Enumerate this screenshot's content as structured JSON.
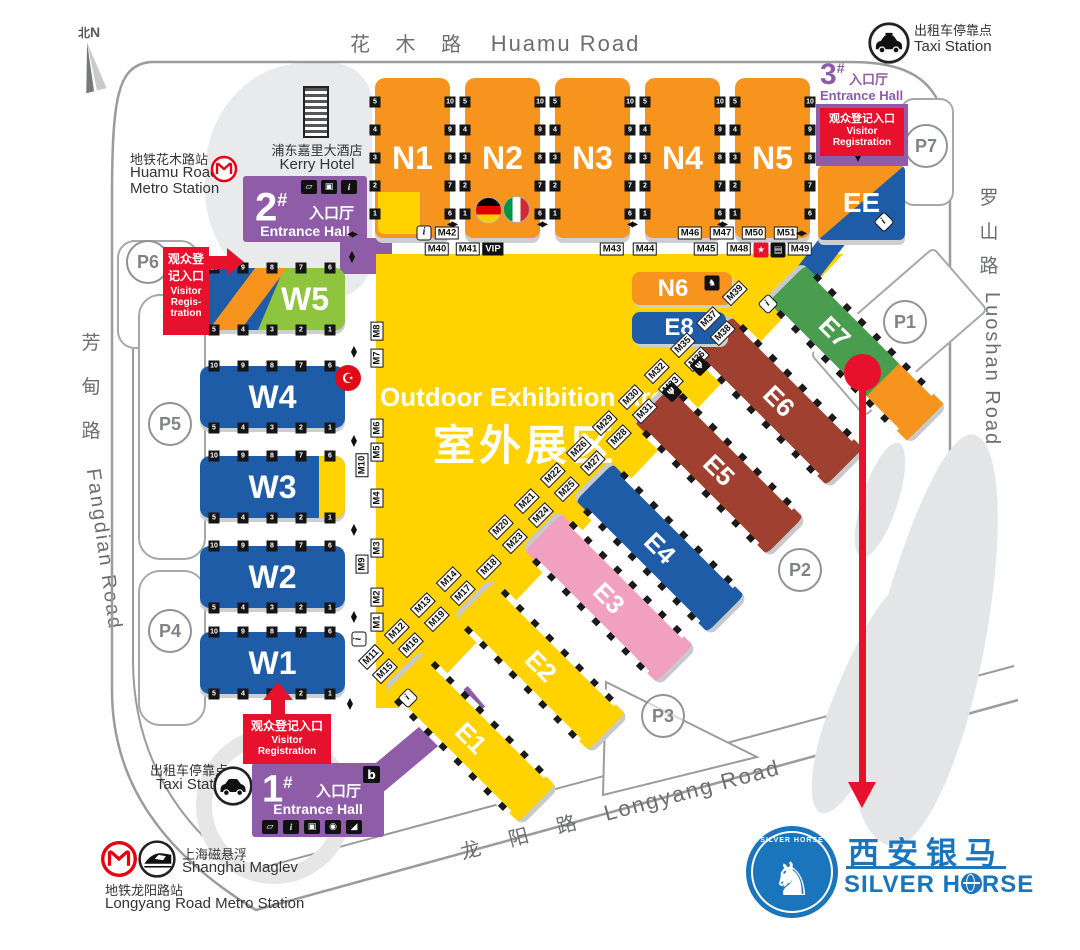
{
  "compass": {
    "zh": "北",
    "en": "N"
  },
  "roads": {
    "huamu": {
      "zh": "花  木  路",
      "en": "Huamu Road"
    },
    "luoshan": {
      "zhChars": [
        "罗",
        "山",
        "路"
      ],
      "en": "Luoshan Road"
    },
    "fangdian": {
      "zhChars": [
        "芳",
        "甸",
        "路"
      ],
      "en": "Fangdian Road"
    },
    "longyang": {
      "zh": "龙  阳  路",
      "en": "Longyang Road"
    }
  },
  "places": {
    "kerry": {
      "zh": "浦东嘉里大酒店",
      "en": "Kerry Hotel"
    },
    "huamuMetro": {
      "zh": "地铁花木路站",
      "en1": "Huamu Road",
      "en2": "Metro Station"
    },
    "taxiTop": {
      "zh": "出租车停靠点",
      "en": "Taxi Station"
    },
    "taxiBottom": {
      "zh": "出租车停靠点",
      "en": "Taxi Station"
    },
    "maglev": {
      "zh": "上海磁悬浮",
      "en": "Shanghai Maglev"
    },
    "longyangMetro": {
      "zh": "地铁龙阳路站",
      "en": "Longyang Road Metro Station"
    }
  },
  "entrances": {
    "h1": {
      "num": "1",
      "hash": "#",
      "zh": "入口厅",
      "en": "Entrance Hall"
    },
    "h2": {
      "num": "2",
      "hash": "#",
      "zh": "入口厅",
      "en": "Entrance Hall"
    },
    "h3": {
      "num": "3",
      "hash": "#",
      "zh": "入口厅",
      "en": "Entrance Hall"
    }
  },
  "reg": {
    "left": {
      "zh1": "观众登",
      "zh2": "记入口",
      "en1": "Visitor",
      "en2": "Regis-",
      "en3": "tration"
    },
    "right": {
      "zh": "观众登记入口",
      "en1": "Visitor",
      "en2": "Registration"
    },
    "bottom": {
      "zh": "观众登记入口",
      "en1": "Visitor",
      "en2": "Registration"
    }
  },
  "outdoor": {
    "en": "Outdoor Exhibition Area",
    "zh": "室外展区"
  },
  "halls": {
    "north": [
      "N1",
      "N2",
      "N3",
      "N4",
      "N5"
    ],
    "west": [
      "W5",
      "W4",
      "W3",
      "W2",
      "W1"
    ],
    "east": [
      "E1",
      "E2",
      "E3",
      "E4",
      "E5",
      "E6",
      "E7"
    ],
    "n6": "N6",
    "e8": "E8",
    "ee": "EE"
  },
  "parking": [
    "P1",
    "P2",
    "P3",
    "P4",
    "P5",
    "P6",
    "P7"
  ],
  "rooms": {
    "nLeftTop": "M42",
    "nLeftBottom": [
      "M40",
      "M41"
    ],
    "vip": "VIP",
    "nMid": [
      "M43",
      "M44"
    ],
    "nRightTop": [
      "M46",
      "M47",
      "M50",
      "M51"
    ],
    "nRightBottom": [
      "M45",
      "M48",
      "M49"
    ],
    "wCol": [
      "M8",
      "M7",
      "M6",
      "M5",
      "M10",
      "M4",
      "M3",
      "M9",
      "M2",
      "M1"
    ],
    "diagPairs": [
      [
        "M11",
        "M15"
      ],
      [
        "M12",
        "M16"
      ],
      [
        "M13",
        "M19"
      ],
      [
        "M14",
        "M17"
      ],
      [
        "",
        "M18"
      ],
      [
        "M20",
        "M23"
      ],
      [
        "M21",
        "M24"
      ],
      [
        "M22",
        "M25"
      ],
      [
        "M26",
        "M27"
      ],
      [
        "M29",
        "M28"
      ],
      [
        "M30",
        "M31"
      ],
      [
        "M32",
        "M33"
      ],
      [
        "M35",
        "M36"
      ],
      [
        "M37",
        "M38"
      ],
      [
        "M39",
        ""
      ]
    ]
  },
  "gates": {
    "wTop": [
      "10",
      "9",
      "8",
      "7",
      "6"
    ],
    "wBottom": [
      "5",
      "4",
      "3",
      "2",
      "1"
    ],
    "nLeft": [
      "5",
      "4",
      "3",
      "2",
      "1"
    ],
    "nRight": [
      "10",
      "9",
      "8",
      "7",
      "6"
    ]
  },
  "icons": {
    "info": "i",
    "star": "★",
    "vip": "VIP",
    "b": "b",
    "crescent": "☪",
    "statue": "♞",
    "ticket": "▱",
    "luggage": "▣",
    "camera": "◉",
    "escalator": "◢",
    "card": "▤",
    "fork": "Ψ",
    "arrowH": "◀▶",
    "arrowUp": "▲",
    "arrowDown": "▼"
  },
  "logo": {
    "badgeArc": "SILVER HORSE",
    "zh": "西安银马",
    "enPre": "SILVER H",
    "enPost": "RSE"
  },
  "colors": {
    "orange": "#f7941e",
    "yellow": "#ffd200",
    "blue": "#1e5ca8",
    "green": "#4a9c4e",
    "pink": "#f2a0c0",
    "brown": "#a04030",
    "purple": "#8f5ca7",
    "red": "#e8112d",
    "logoBlue": "#1b75bc"
  }
}
